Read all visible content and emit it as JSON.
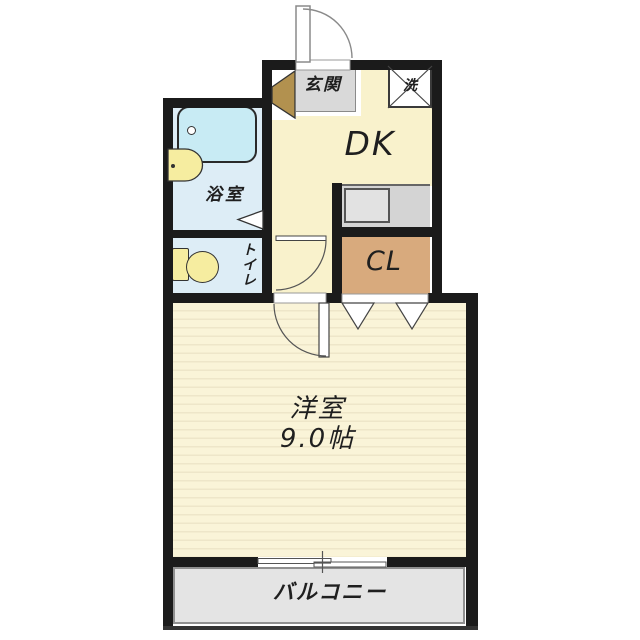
{
  "plan": {
    "type": "japanese-apartment-floor-plan",
    "labels": {
      "genkan": "玄関",
      "washer": "洗",
      "dk": "DK",
      "bathroom": "浴室",
      "toilet": "トイレ",
      "closet": "CL",
      "room_name": "洋室",
      "room_size": "9.0帖",
      "balcony": "バルコニー"
    },
    "colors": {
      "wall": "#1b1b1b",
      "dk_floor": "#f9f2cc",
      "wet_area_floor": "#ddedf6",
      "bathtub": "#c8ebf4",
      "fixture_yellow": "#f6eda0",
      "closet": "#d8aa7d",
      "room_floor": "#faf4d8",
      "room_stripe": "#eee6c9",
      "balcony_floor": "#e4e4e4",
      "genkan_floor": "#d9d9d9",
      "counter": "#d4d4d4",
      "shoe_cabinet": "#b2914f"
    }
  }
}
